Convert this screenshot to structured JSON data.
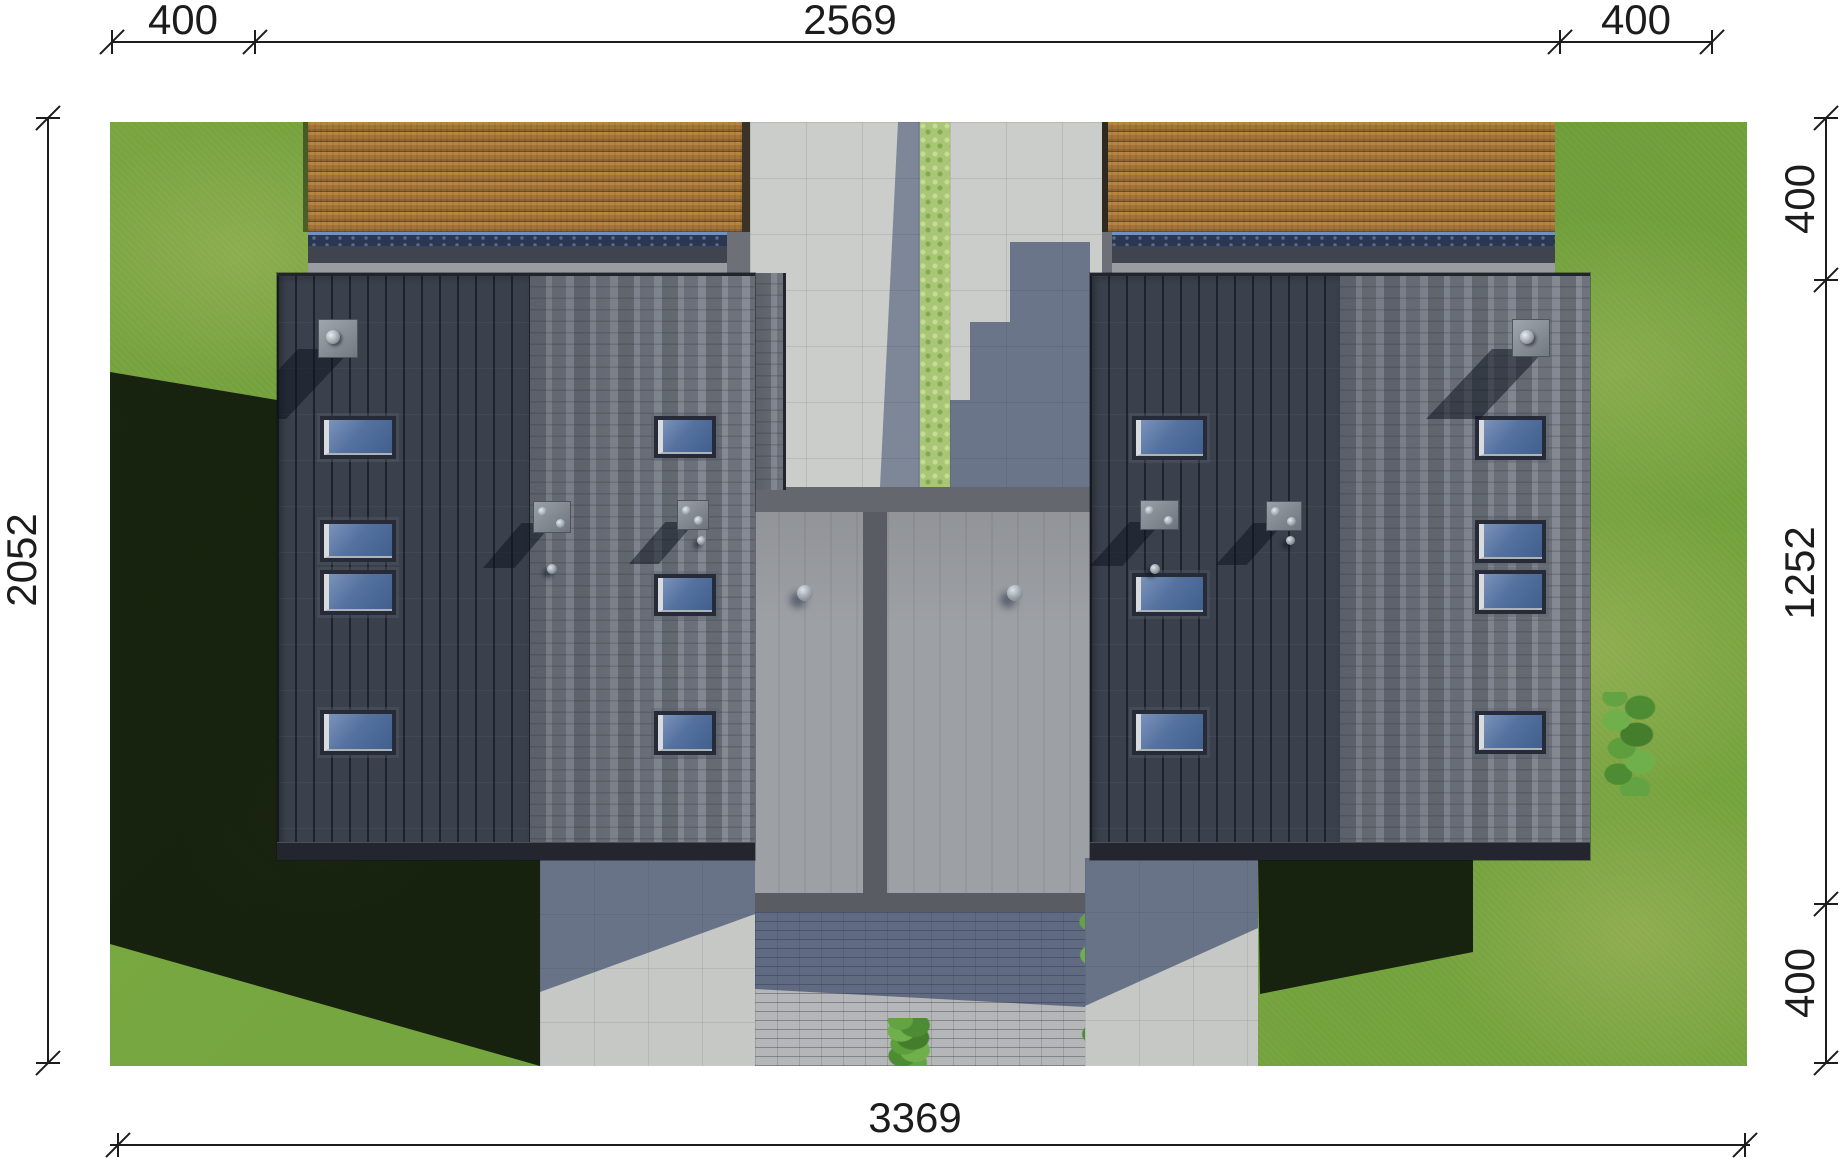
{
  "drawing": {
    "type": "roof-plan-top-view",
    "dimensions": {
      "top": [
        "400",
        "2569",
        "400"
      ],
      "right": [
        "400",
        "1252",
        "400"
      ],
      "left": [
        "2052"
      ],
      "bottom": [
        "3369"
      ]
    }
  },
  "colors": {
    "background": "#ffffff",
    "dimension_line": "#1c1c1c",
    "grass": "#74a03c",
    "grass_shadow": "#0b110b",
    "roof_standing_seam": "#3a404c",
    "roof_tiles": "#7c818b",
    "deck_wood": "#a3733a",
    "paving": "#cbcdca",
    "hedge": "#a8c676",
    "flat_roof_panel": "#9da0a5",
    "skylight_glass": "#54719f",
    "cast_shadow_blue": "#1c2e56"
  }
}
